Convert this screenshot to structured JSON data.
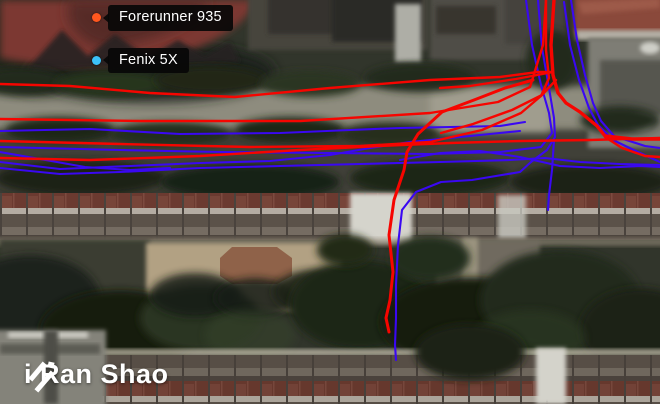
{
  "legend": {
    "items": [
      {
        "label": "Forerunner 935",
        "color": "#ff571f"
      },
      {
        "label": "Fenix 5X",
        "color": "#3cc2f9"
      }
    ]
  },
  "logo": {
    "text": "i Ran Shao"
  },
  "tracks": {
    "blue": {
      "name": "Fenix 5X",
      "color": "#3a08f2",
      "width": 2.1,
      "paths": [
        {
          "points": "538,0 542,48 549,88 554,118 555,137 547,150 531,162 520,172 472,180 441,182 416,192 402,210 398,245 396,285 396,318 395,345 396,360"
        },
        {
          "points": "526,0 532,45 541,85 549,113 552,133 541,147 500,152 430,154 330,153 220,152 120,150 0,147"
        },
        {
          "points": "571,0 577,40 585,75 593,103 601,121 614,136 645,146 660,148"
        },
        {
          "points": "564,2 570,45 579,80 589,108 598,125 613,140 638,152 660,162"
        },
        {
          "points": "0,131 90,129 180,134 280,133 350,130 400,128 450,127 500,126 525,122"
        },
        {
          "points": "0,162 60,169 130,166 200,163 270,161 330,155 370,148 410,142 450,138 490,134 520,131"
        },
        {
          "points": "0,168 60,174 120,172 200,168 280,166 360,164 440,162 510,160 545,158 580,162 620,164 660,165"
        },
        {
          "points": "554,140 552,170 549,195 548,210"
        },
        {
          "points": "400,160 440,153 480,151 520,157 560,166 600,168 640,166 660,167"
        },
        {
          "points": "0,152 40,159 85,167 130,170 170,168"
        }
      ]
    },
    "red": {
      "name": "Forerunner 935",
      "color": "#f60500",
      "width": 2.4,
      "paths": [
        {
          "points": "0,84 70,86 150,93 235,97 330,88 430,80 500,77 538,72 553,72"
        },
        {
          "points": "0,119 140,121 300,121 430,113 498,102 530,87 543,45 546,0"
        },
        {
          "points": "554,0 551,45 553,75 558,93 566,103 580,112 597,126 605,136 632,139 660,139",
          "w": 3.4
        },
        {
          "points": "546,0 546,50 549,78 541,96 521,113 482,130 430,142 360,146 250,147 120,144 0,141"
        },
        {
          "points": "0,158 90,160 200,156 300,150 380,146 450,143 520,141 590,140 660,138"
        },
        {
          "points": "533,80 505,88 474,100 442,112 418,134 407,152 404,170 394,200 389,235 393,272 390,300 386,318 389,332",
          "w": 3
        },
        {
          "points": "605,137 622,148 645,156 660,157"
        },
        {
          "points": "553,72 516,79 470,86 440,88"
        },
        {
          "points": "556,80 542,95 512,110 473,124 441,133"
        }
      ]
    }
  }
}
